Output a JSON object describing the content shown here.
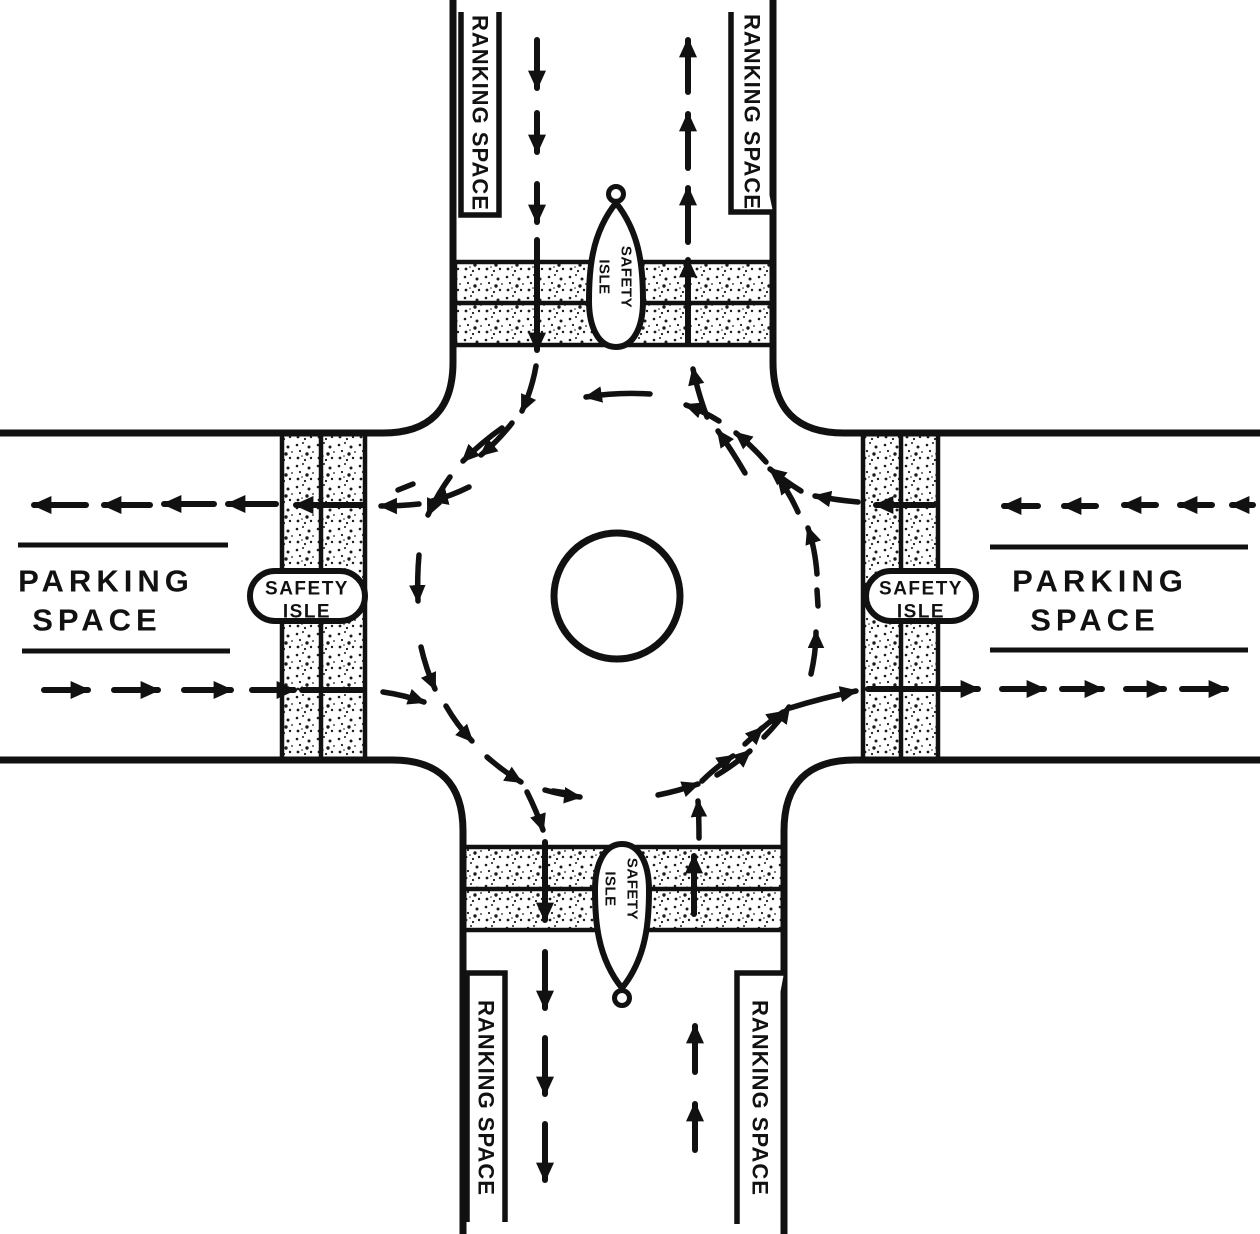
{
  "colors": {
    "ink": "#111111",
    "paper": "#ffffff"
  },
  "north_road": {
    "left_box_label": "RANKING SPACE",
    "right_box_label": "RANKING SPACE",
    "island": {
      "line1": "SAFETY",
      "line2": "ISLE"
    }
  },
  "south_road": {
    "left_box_label": "RANKING SPACE",
    "right_box_label": "RANKING SPACE",
    "island": {
      "line1": "SAFETY",
      "line2": "ISLE"
    }
  },
  "west_road": {
    "area_line1": "PARKING",
    "area_line2": "SPACE",
    "island": {
      "line1": "SAFETY",
      "line2": "ISLE"
    }
  },
  "east_road": {
    "area_line1": "PARKING",
    "area_line2": "SPACE",
    "island": {
      "line1": "SAFETY",
      "line2": "ISLE"
    }
  }
}
